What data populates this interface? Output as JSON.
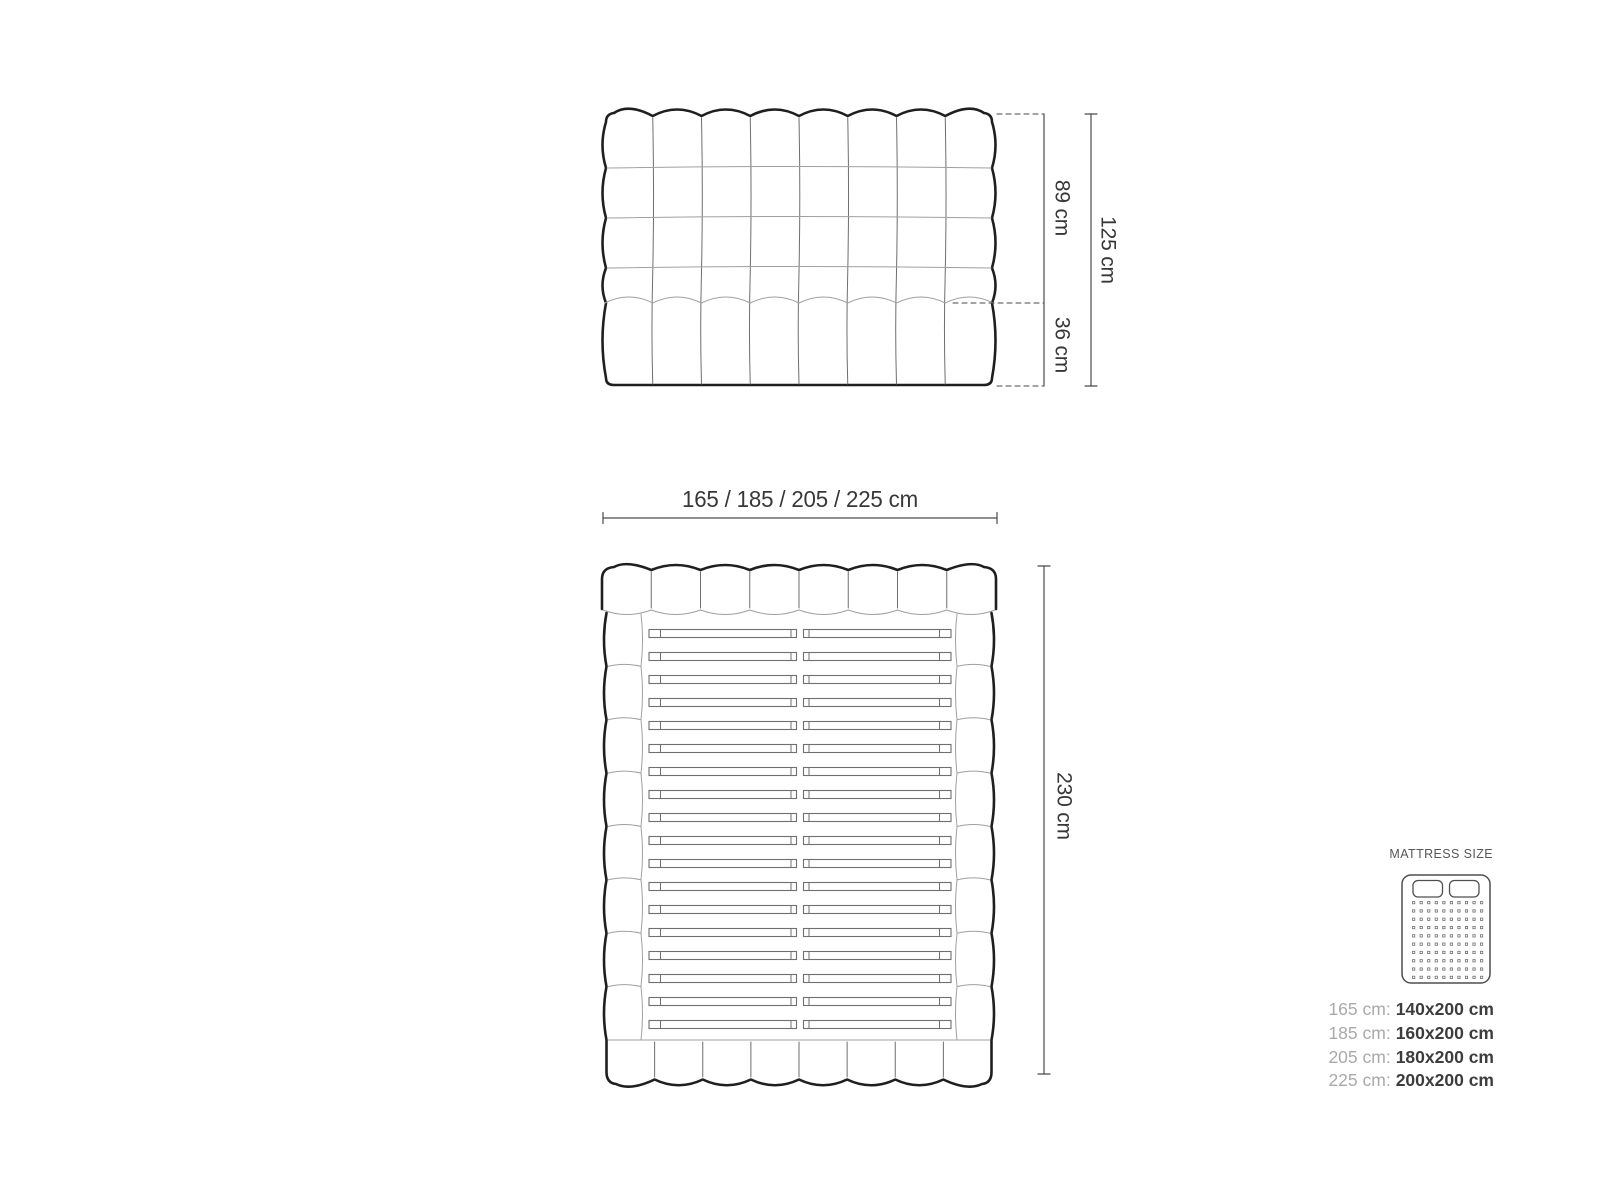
{
  "figure": {
    "colors": {
      "outline": "#1f1f1f",
      "thin": "#a0a0a0",
      "mid": "#6e6e6e",
      "slat": "#6f6f6f",
      "dim": "#4a4a4a",
      "text": "#383838",
      "icon": "#4f4f4f"
    },
    "front_view": {
      "columns": 8,
      "grid_rows": 4,
      "upper_height_label": "89 cm",
      "lower_height_label": "36 cm",
      "total_height_label": "125 cm"
    },
    "width_dimension_label": "165 / 185 / 205 / 225 cm",
    "top_view": {
      "headboard_segments": 8,
      "side_segments": 8,
      "footer_segments": 8,
      "slat_count": 18,
      "length_label": "230 cm"
    }
  },
  "legend": {
    "title": "MATTRESS SIZE",
    "icon": {
      "pillows": 2,
      "dot_columns": 10,
      "dot_rows": 10
    },
    "rows": [
      {
        "prefix": "165 cm:",
        "value": "140x200 cm"
      },
      {
        "prefix": "185 cm:",
        "value": "160x200 cm"
      },
      {
        "prefix": "205 cm:",
        "value": "180x200 cm"
      },
      {
        "prefix": "225 cm:",
        "value": "200x200 cm"
      }
    ]
  }
}
